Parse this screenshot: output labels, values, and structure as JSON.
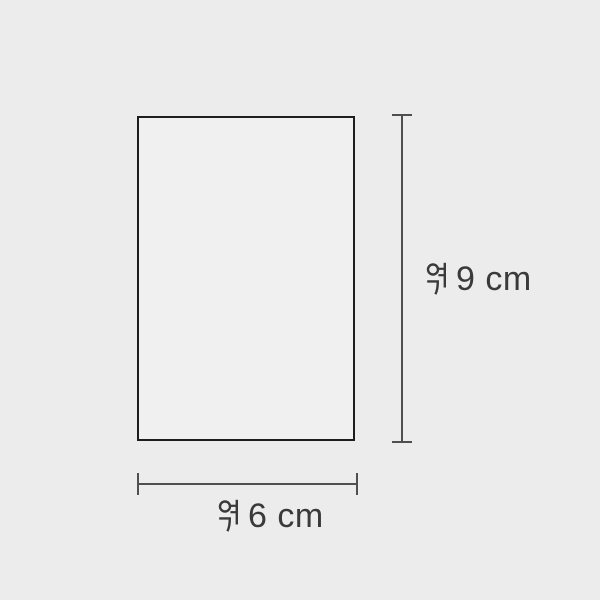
{
  "theme": {
    "background_color": "#ececec",
    "shape_fill": "#f0f0f0",
    "shape_border": "#1d1d1d",
    "dim_line_color": "#4f4f4f",
    "text_color": "#3a3a3a"
  },
  "diagram": {
    "shape": "rectangle",
    "height_dimension": {
      "label": "약 9 cm",
      "approx_prefix": "약",
      "value_text": "9 cm"
    },
    "width_dimension": {
      "label": "약 6 cm",
      "approx_prefix": "약",
      "value_text": "6 cm"
    }
  }
}
